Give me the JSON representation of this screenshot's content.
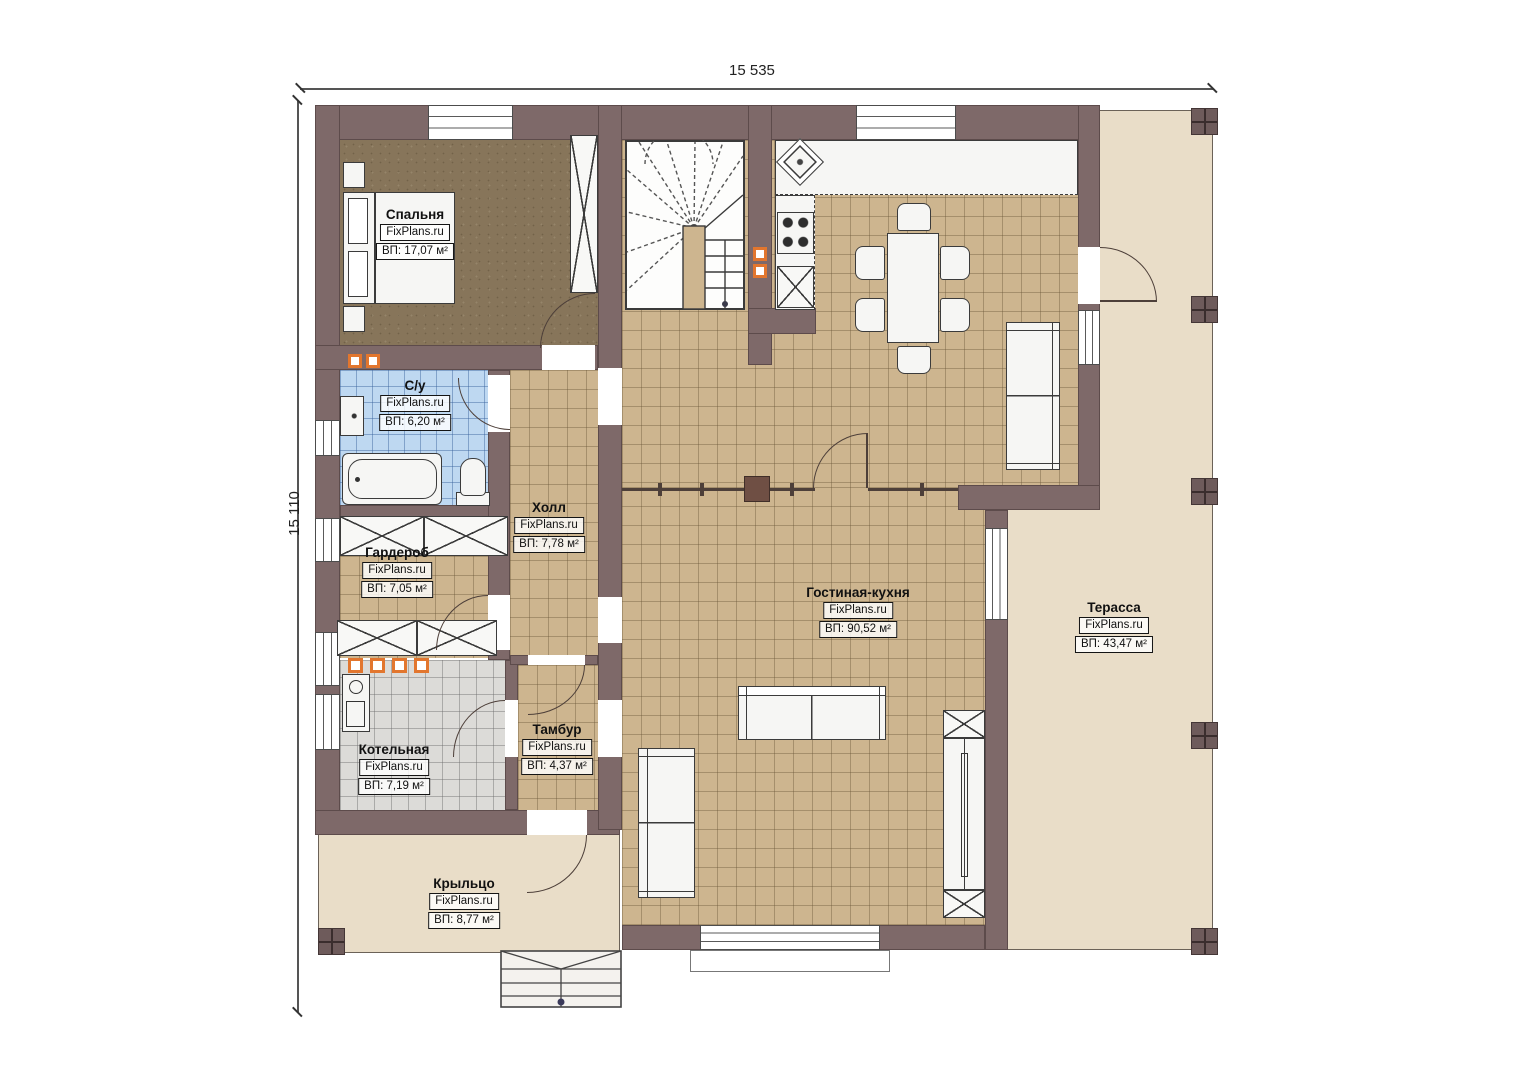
{
  "plan": {
    "dimensions": {
      "top": "15 535",
      "left": "15 110"
    },
    "watermark": "FixPlans.ru",
    "rooms": [
      {
        "id": "bedroom",
        "name": "Спальня",
        "watermark": "FixPlans.ru",
        "area": "ВП: 17,07 м²"
      },
      {
        "id": "bathroom",
        "name": "С/у",
        "watermark": "FixPlans.ru",
        "area": "ВП: 6,20 м²"
      },
      {
        "id": "hall",
        "name": "Холл",
        "watermark": "FixPlans.ru",
        "area": "ВП: 7,78 м²"
      },
      {
        "id": "wardrobe",
        "name": "Гардероб",
        "watermark": "FixPlans.ru",
        "area": "ВП: 7,05 м²"
      },
      {
        "id": "boiler-room",
        "name": "Котельная",
        "watermark": "FixPlans.ru",
        "area": "ВП: 7,19 м²"
      },
      {
        "id": "vestibule",
        "name": "Тамбур",
        "watermark": "FixPlans.ru",
        "area": "ВП: 4,37 м²"
      },
      {
        "id": "living-kitchen",
        "name": "Гостиная-кухня",
        "watermark": "FixPlans.ru",
        "area": "ВП: 90,52 м²"
      },
      {
        "id": "terrace",
        "name": "Терасса",
        "watermark": "FixPlans.ru",
        "area": "ВП: 43,47 м²"
      },
      {
        "id": "porch",
        "name": "Крыльцо",
        "watermark": "FixPlans.ru",
        "area": "ВП: 8,77 м²"
      }
    ],
    "colors": {
      "wall": "#7e6969",
      "tile_tan": "#cdb58f",
      "tile_blue": "#bed8f1",
      "tile_gray": "#dcdbd8",
      "bedroom_floor": "#87755a",
      "deck": "#e9ddc8",
      "accent_orange": "#e2762e"
    }
  }
}
